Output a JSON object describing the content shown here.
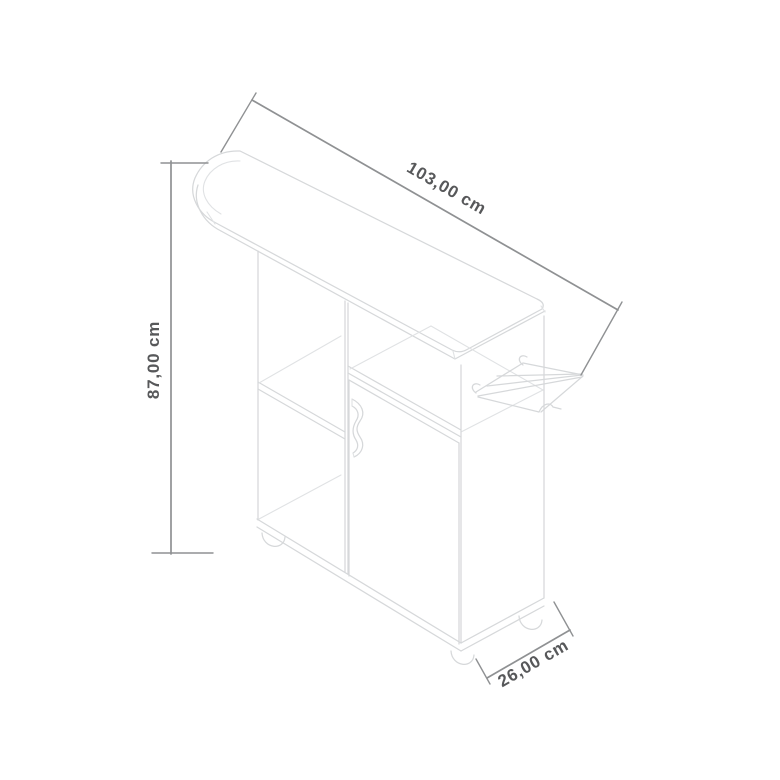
{
  "diagram": {
    "unit": "cm",
    "dimensions": {
      "width": {
        "label": "103,00 cm",
        "value": "103,00"
      },
      "height": {
        "label": "87,00 cm",
        "value": "87,00"
      },
      "depth": {
        "label": "26,00 cm",
        "value": "26,00"
      }
    },
    "colors": {
      "background": "#ffffff",
      "furniture_line": "#d6d8da",
      "dimension_line": "#8f9193",
      "label_text": "#57585a"
    }
  }
}
